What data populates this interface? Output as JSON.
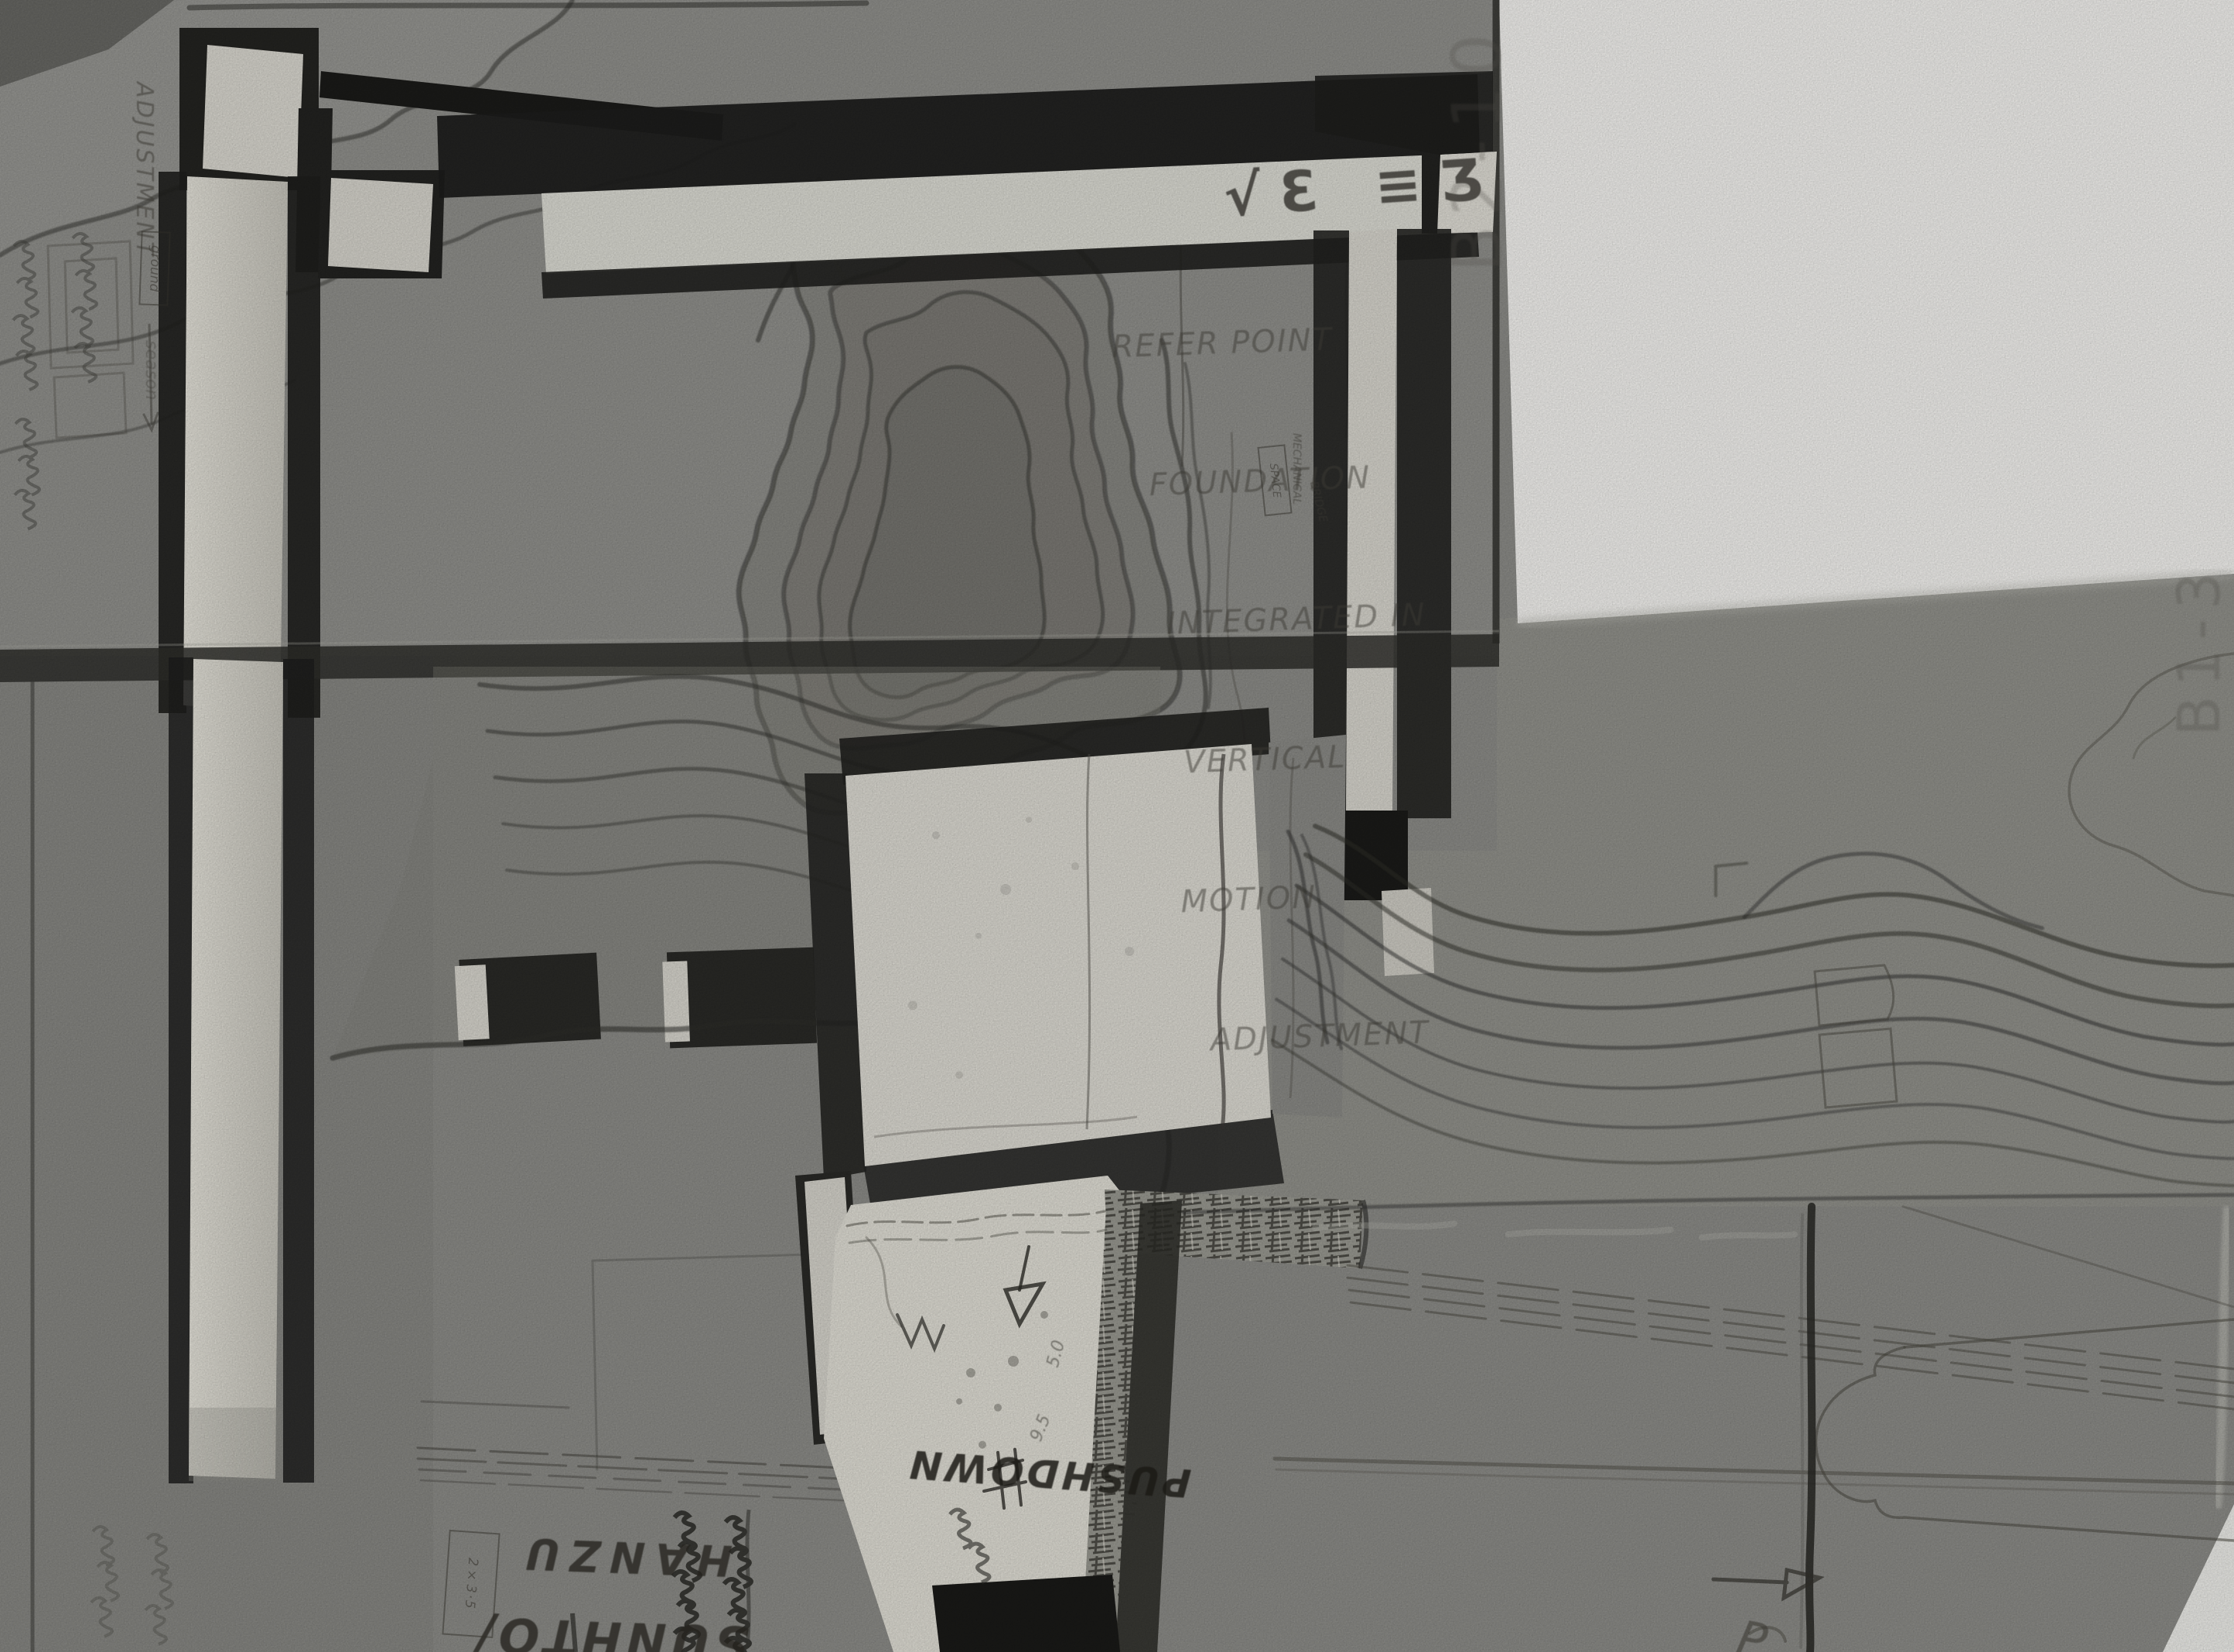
{
  "scene": {
    "kind": "photograph of a cardboard architectural site model, top view, black and white",
    "palette": {
      "paper": "#f4f3f0",
      "cardboard": "#8d8d89",
      "cardboard_recess": "#7b7b76",
      "groove_shadow": "#21211e",
      "foam_white": "#dedcd3",
      "pencil": "#44423c"
    }
  },
  "annotations": {
    "note_top_right": {
      "lines": [
        "REFER POINT",
        "FOUNDATION",
        "INTEGRATED IN",
        "VERTICAL",
        "MOTION",
        "ADJUSTMENT"
      ]
    },
    "white_bar_marks": "√Ɛ ≡Ʒ",
    "left_margin": {
      "vertical_label": "ADJUSTMENT",
      "boxed_word": "ground",
      "arrow_word": "season"
    },
    "panel_codes": {
      "top_left_panel": "B2-10",
      "right_panel": "B1-3"
    },
    "plinth": {
      "pushdown": "PUSHDOWN",
      "side_mark_a": "5.0",
      "side_mark_b": "9.5",
      "corner_letter": "P"
    },
    "bottom_left": {
      "rot180_line1": "SUNHTO/",
      "rot180_line2": "HANZU",
      "boxed_code": "2×3·5"
    },
    "label_cluster": {
      "boxed": "SPACE",
      "col_a": "MECHANICAL",
      "col_b": "BRIDGE"
    }
  }
}
